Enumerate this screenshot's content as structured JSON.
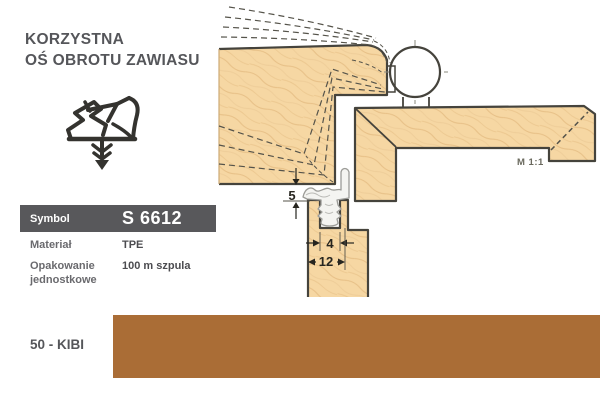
{
  "header": {
    "title_line1": "KORZYSTNA",
    "title_line2": "OŚ OBROTU ZAWIASU"
  },
  "product": {
    "symbol_label": "Symbol",
    "symbol_value": "S 6612",
    "material_label": "Materiał",
    "material_value": "TPE",
    "packaging_label_line1": "Opakowanie",
    "packaging_label_line2": "jednostkowe",
    "packaging_value": "100 m szpula"
  },
  "color_swatch": {
    "label": "50 - KIBI",
    "hex": "#aa6d36"
  },
  "drawing": {
    "scale_label": "M 1:1",
    "dim_gap": "5",
    "dim_groove_width": "4",
    "dim_overall_width": "12"
  },
  "icons": {
    "seal_profile": "seal-profile-cross-section-icon"
  },
  "colors": {
    "swatch": "#aa6d36",
    "table_header_bg": "#58585b",
    "wood_fill": "#f6d7a3",
    "outline": "#45433c"
  }
}
